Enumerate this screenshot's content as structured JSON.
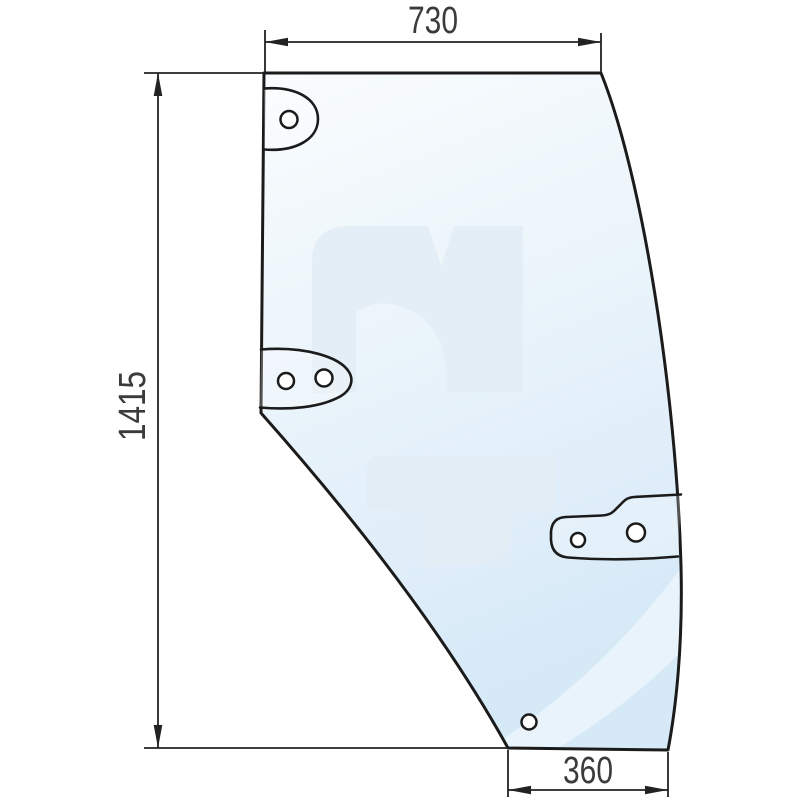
{
  "drawing": {
    "title": "door-glass-panel-technical-drawing",
    "background": "#ffffff",
    "dims": {
      "top": "730",
      "height": "1415",
      "bottom": "360"
    },
    "colors": {
      "outline": "#1b1b1b",
      "dimension_lines": "#222222",
      "dimension_text": "#3b3b3b",
      "glass_tint_top": "#f8fbfe",
      "glass_tint_bottom": "#d7e9f7",
      "watermark": "#e2ecf5"
    },
    "features": {
      "top_tab_holes": 1,
      "middle_tab_holes": 2,
      "side_bracket_holes": 2,
      "bottom_holes": 1
    }
  }
}
